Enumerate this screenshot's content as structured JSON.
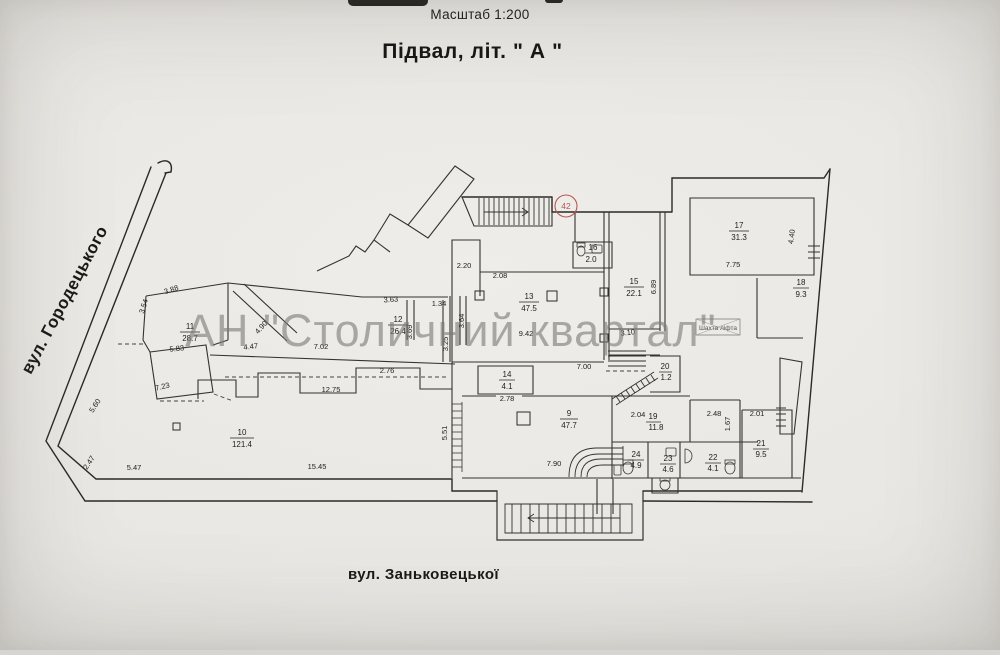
{
  "header": {
    "scale": "Масштаб 1:200",
    "title": "Підвал, літ. \" А \""
  },
  "streets": {
    "left": "вул. Городецького",
    "bottom": "вул. Заньковецької"
  },
  "watermark": "АН \"Столичний квартал\"",
  "marker": {
    "value": "42",
    "color": "#b8564f"
  },
  "labels": {
    "shaft": "Шахта ліфта"
  },
  "rooms": [
    {
      "n": "9",
      "a": "47.7"
    },
    {
      "n": "10",
      "a": "121.4"
    },
    {
      "n": "11",
      "a": "28.7"
    },
    {
      "n": "12",
      "a": "26.4"
    },
    {
      "n": "13",
      "a": "47.5"
    },
    {
      "n": "14",
      "a": "4.1"
    },
    {
      "n": "15",
      "a": "22.1"
    },
    {
      "n": "16",
      "a": "2.0"
    },
    {
      "n": "17",
      "a": "31.3"
    },
    {
      "n": "18",
      "a": "9.3"
    },
    {
      "n": "19",
      "a": "11.8"
    },
    {
      "n": "20",
      "a": "1.2"
    },
    {
      "n": "21",
      "a": "9.5"
    },
    {
      "n": "22",
      "a": "4.1"
    },
    {
      "n": "23",
      "a": "4.6"
    },
    {
      "n": "24",
      "a": "4.9"
    }
  ],
  "dims": [
    "3.88",
    "3.54",
    "5.83",
    "7.23",
    "4.90",
    "4.47",
    "12.75",
    "7.02",
    "2.76",
    "3.63",
    "1.34",
    "3.69",
    "3.25",
    "3.64",
    "2.20",
    "2.08",
    "9.42",
    "7.00",
    "2.78",
    "5.51",
    "6.89",
    "7.75",
    "4.40",
    "3.10",
    "2.04",
    "2.48",
    "1.67",
    "2.01",
    "7.90",
    "5.47",
    "15.45",
    "2.47",
    "5.60"
  ]
}
